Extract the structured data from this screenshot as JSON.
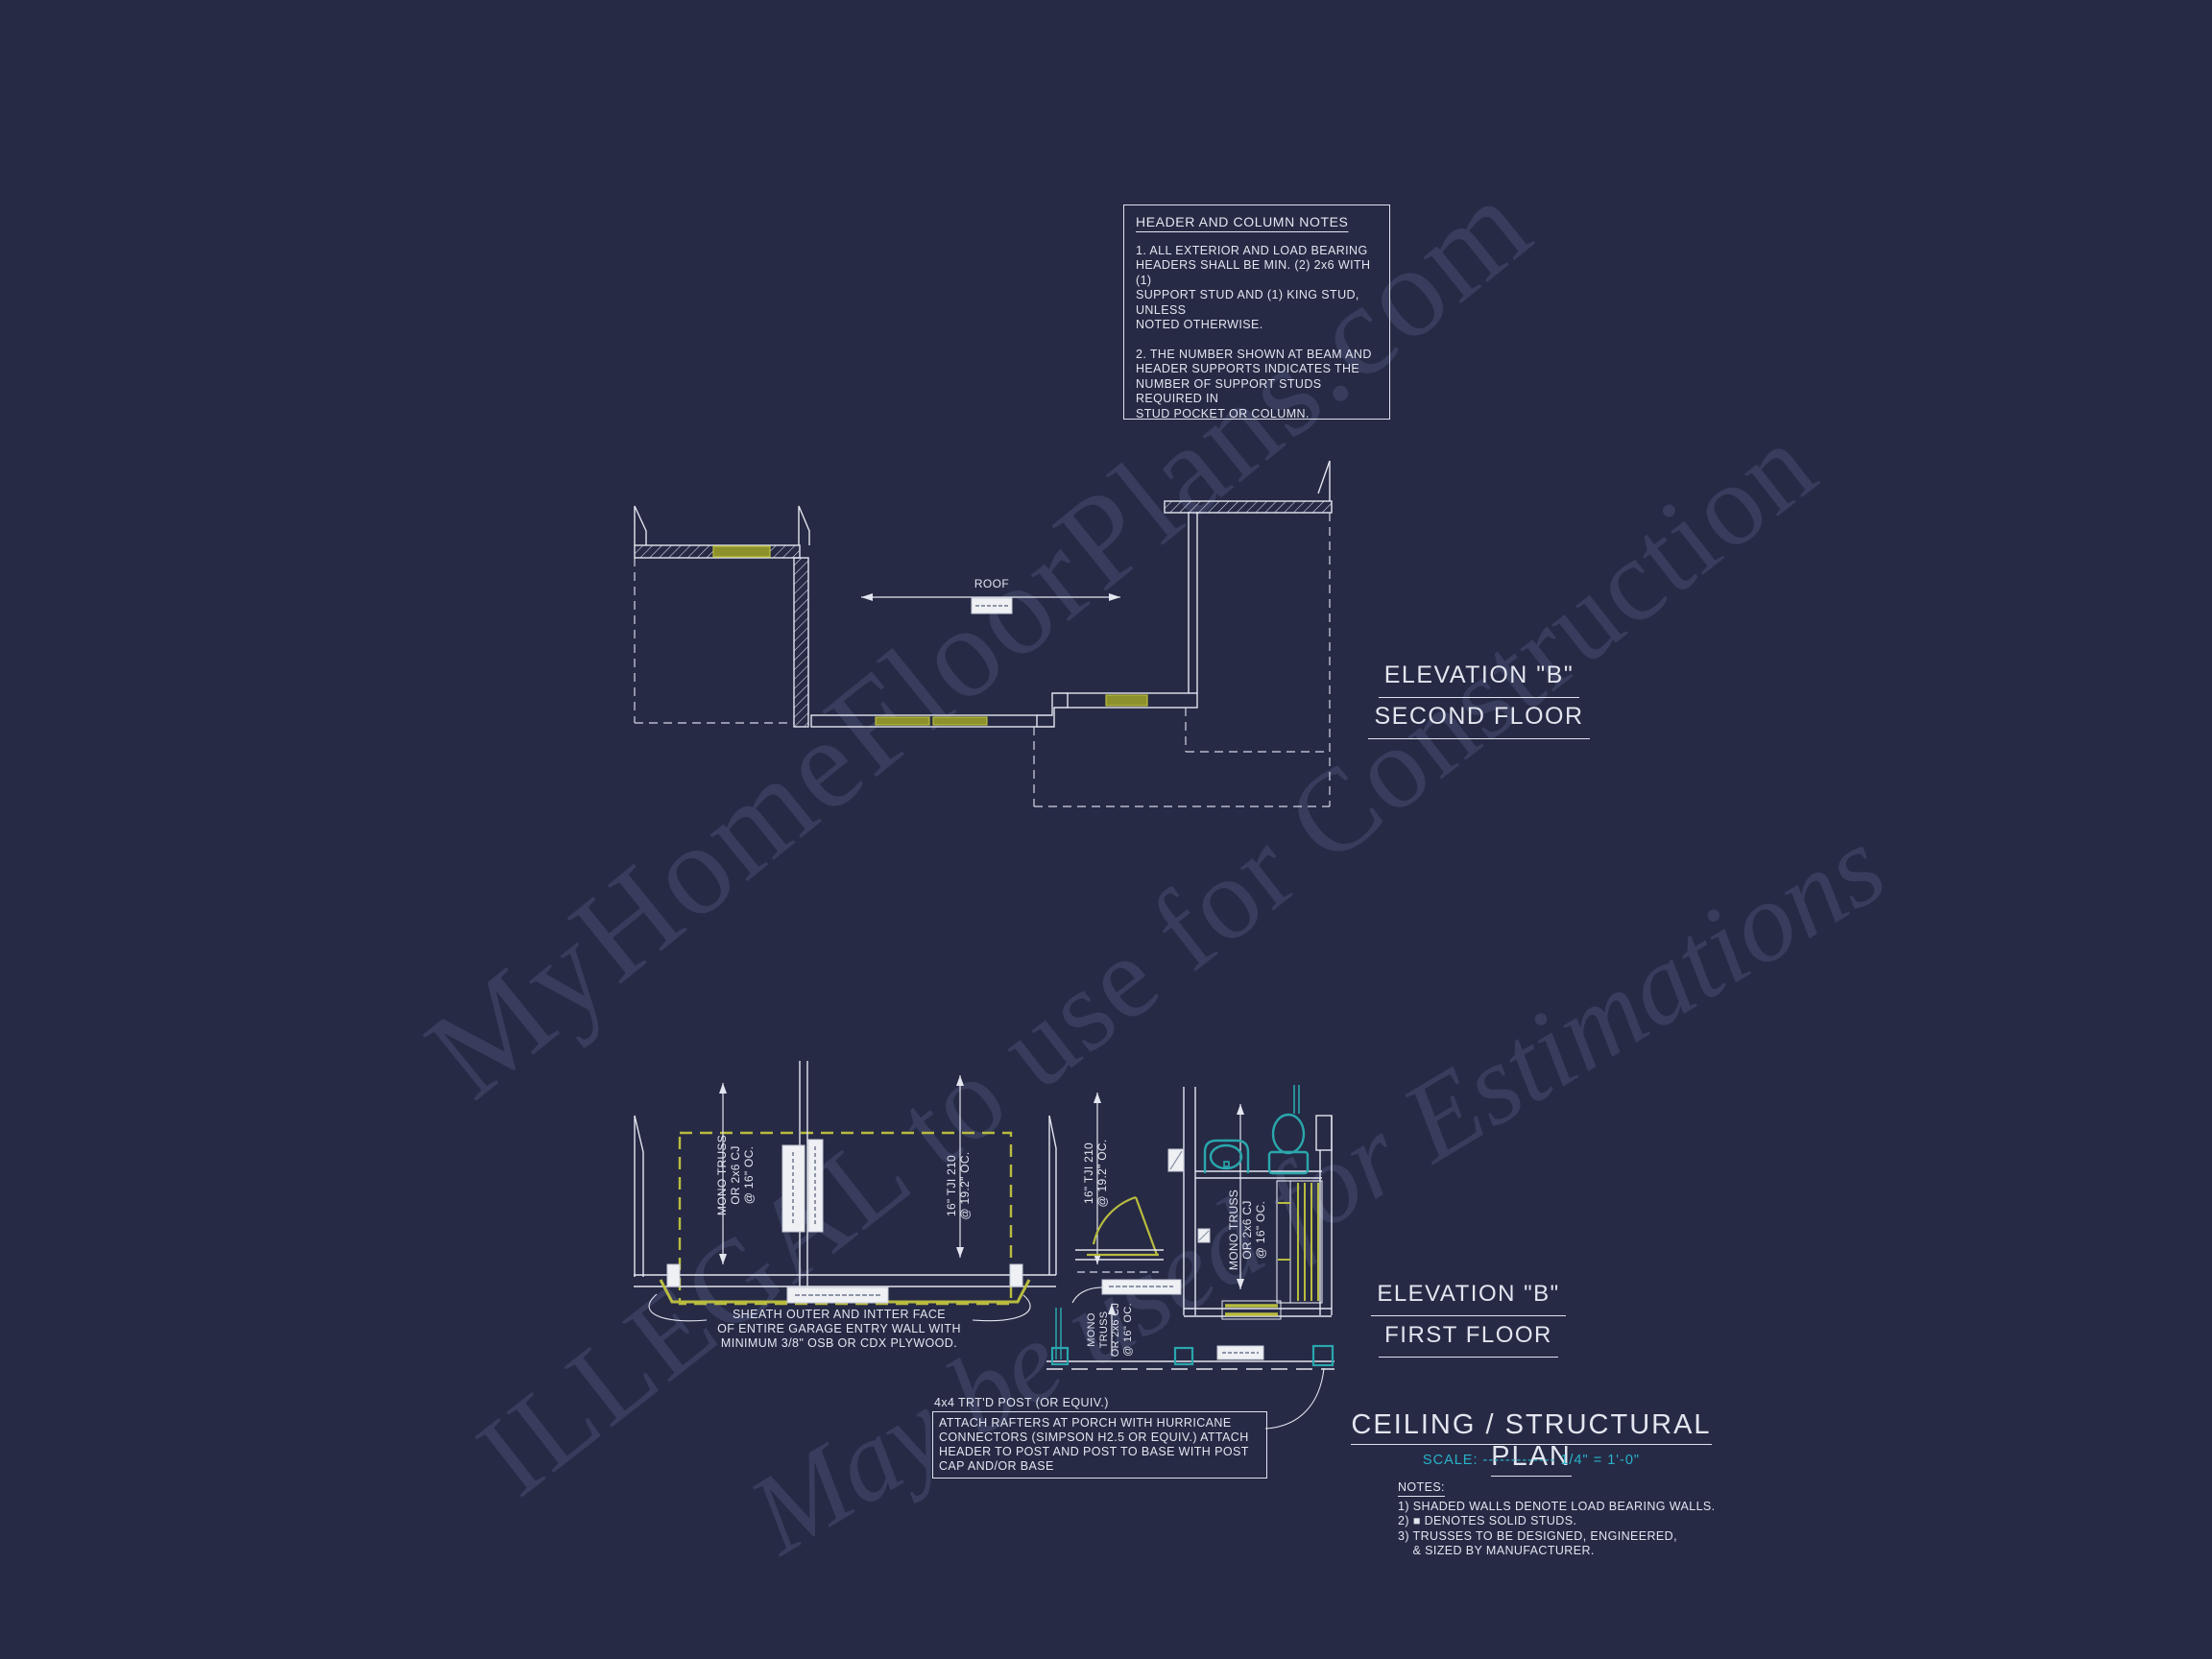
{
  "colors": {
    "background": "#262a45",
    "line_white": "#e3e5ef",
    "header_yellow": "#b9bc3f",
    "header_fill": "#8d912c",
    "fixture_teal": "#2aa7ad",
    "scale_cyan": "#29b2c8",
    "watermark": "rgba(150,160,215,0.17)"
  },
  "watermarks": {
    "wm1": "MyHomeFloorPlans.com",
    "wm2": "ILLEGAL to use for Construction",
    "wm3": "May be used for Estimations"
  },
  "header_notes": {
    "title": "HEADER AND COLUMN NOTES",
    "note1": "1. ALL EXTERIOR AND LOAD BEARING\nHEADERS SHALL BE MIN. (2) 2x6 WITH (1)\nSUPPORT STUD AND (1) KING STUD, UNLESS\nNOTED OTHERWISE.",
    "note2": "2. THE NUMBER SHOWN AT BEAM AND\nHEADER SUPPORTS INDICATES THE\nNUMBER OF SUPPORT STUDS REQUIRED IN\nSTUD POCKET OR COLUMN."
  },
  "second_floor": {
    "title_line1": "ELEVATION \"B\"",
    "title_line2": "SECOND FLOOR",
    "roof_label": "ROOF"
  },
  "first_floor": {
    "title_line1": "ELEVATION \"B\"",
    "title_line2": "FIRST FLOOR",
    "labels": {
      "mono_truss_garage": "MONO TRUSS\nOR 2x6 CJ\n@ 16\" OC.",
      "tji_garage": "16\" TJI 210\n@ 19.2\" OC.",
      "tji_hall": "16\" TJI 210\n@ 19.2\" OC.",
      "mono_truss_bath": "MONO TRUSS\nOR 2x6 CJ\n@ 16\" OC.",
      "mono_truss_porch": "MONO\nTRUSS\nOR 2x6 CJ\n@ 16\" OC."
    },
    "sheath_note": "SHEATH OUTER AND INTTER FACE\nOF ENTIRE GARAGE ENTRY WALL WITH\nMINIMUM 3/8\" OSB OR CDX PLYWOOD.",
    "post_note_title": "4x4 TRT'D POST (OR EQUIV.)",
    "post_note_body": "ATTACH RAFTERS AT PORCH WITH HURRICANE\nCONNECTORS (SIMPSON H2.5 OR EQUIV.) ATTACH\nHEADER TO POST AND POST TO BASE WITH POST\nCAP AND/OR BASE"
  },
  "plan_title": {
    "title": "CEILING / STRUCTURAL PLAN",
    "scale_label": "SCALE:",
    "scale_dashes": "-------------",
    "scale_value": "1/4\" = 1'-0\"",
    "notes_title": "NOTES:",
    "notes_body": "1) SHADED WALLS DENOTE LOAD BEARING WALLS.\n2) ■ DENOTES SOLID STUDS.\n3) TRUSSES TO BE DESIGNED, ENGINEERED,\n    & SIZED BY MANUFACTURER."
  }
}
